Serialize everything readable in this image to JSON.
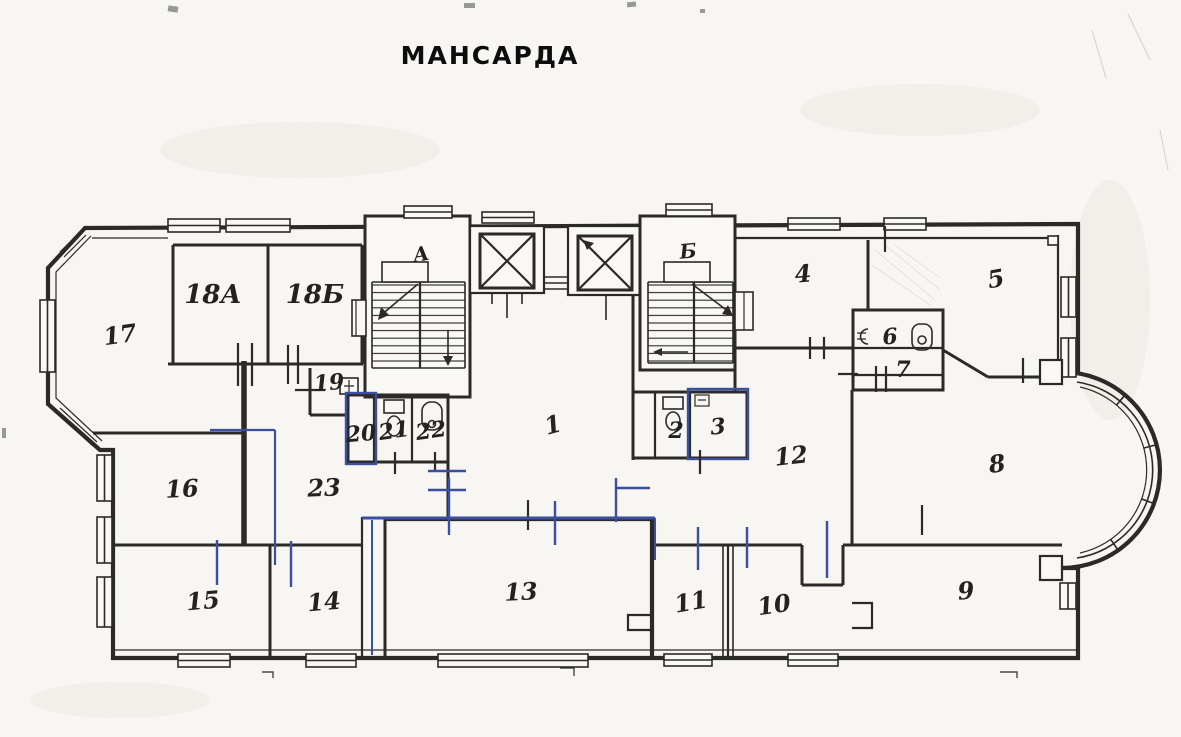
{
  "document": {
    "title": "МАНСАРДА"
  },
  "plan": {
    "stairwells": [
      {
        "label": "А"
      },
      {
        "label": "Б"
      }
    ],
    "rooms": [
      {
        "label": "17"
      },
      {
        "label": "18А"
      },
      {
        "label": "18Б"
      },
      {
        "label": "19"
      },
      {
        "label": "20"
      },
      {
        "label": "21"
      },
      {
        "label": "22"
      },
      {
        "label": "23"
      },
      {
        "label": "16"
      },
      {
        "label": "15"
      },
      {
        "label": "14"
      },
      {
        "label": "13"
      },
      {
        "label": "1"
      },
      {
        "label": "2"
      },
      {
        "label": "3"
      },
      {
        "label": "11"
      },
      {
        "label": "10"
      },
      {
        "label": "12"
      },
      {
        "label": "4"
      },
      {
        "label": "5"
      },
      {
        "label": "6"
      },
      {
        "label": "7"
      },
      {
        "label": "8"
      },
      {
        "label": "9"
      }
    ],
    "colors": {
      "ink": "#2b2a26",
      "annotation_blue": "#3a4fa0",
      "paper": "#f7f6f2"
    }
  }
}
